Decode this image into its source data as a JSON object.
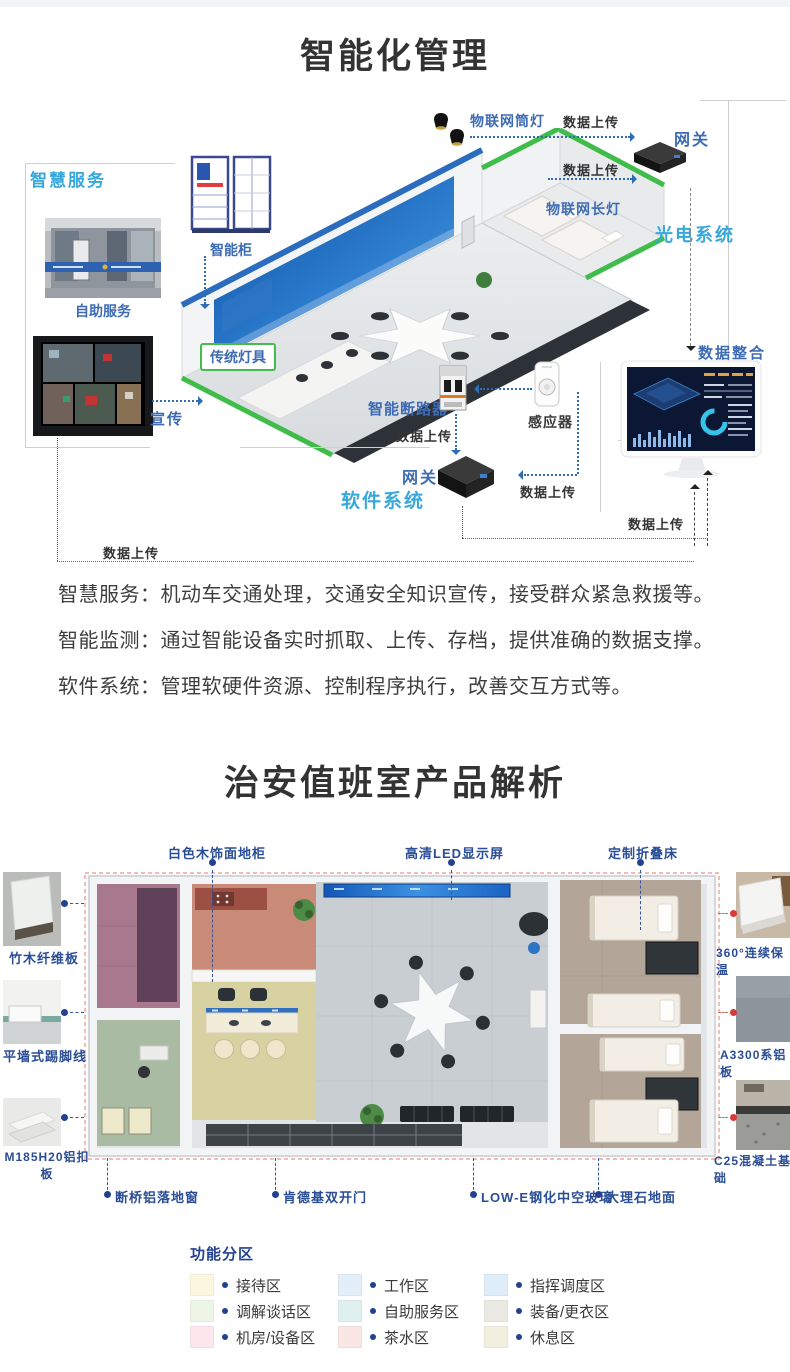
{
  "colors": {
    "label_blue": "#3d6cb4",
    "system_cyan": "#38a8dc",
    "navy": "#23418f",
    "red_dot": "#d93a3a",
    "title": "#333333"
  },
  "s1": {
    "title": "智能化管理",
    "labels": {
      "smart_service": "智慧服务",
      "smart_cabinet": "智能柜",
      "self_service": "自助服务",
      "traditional_light": "传统灯具",
      "publicity": "宣传",
      "iot_downlight": "物联网筒灯",
      "iot_long_light": "物联网长灯",
      "gateway": "网关",
      "optoelectronic_system": "光电系统",
      "smart_breaker": "智能断路器",
      "sensor": "感应器",
      "software_system": "软件系统",
      "data_integration": "数据整合",
      "data_upload": "数据上传"
    },
    "paragraphs": [
      "智慧服务：机动车交通处理，交通安全知识宣传，接受群众紧急救援等。",
      "智能监测：通过智能设备实时抓取、上传、存档，提供准确的数据支撑。",
      "软件系统：管理软硬件资源、控制程序执行，改善交互方式等。"
    ]
  },
  "s2": {
    "title": "治安值班室产品解析",
    "top_labels": [
      "白色木饰面地柜",
      "高清LED显示屏",
      "定制折叠床"
    ],
    "left_labels": [
      "竹木纤维板",
      "平墙式踢脚线",
      "M185H20铝扣板"
    ],
    "right_labels": [
      "360°连续保温",
      "A3300系铝板",
      "C25混凝土基础"
    ],
    "bottom_labels": [
      "断桥铝落地窗",
      "肯德基双开门",
      "LOW-E钢化中空玻璃",
      "大理石地面"
    ],
    "legend": {
      "title": "功能分区",
      "items": [
        {
          "label": "接待区",
          "color": "#faf6e0"
        },
        {
          "label": "工作区",
          "color": "#e3eff8"
        },
        {
          "label": "指挥调度区",
          "color": "#deedf8"
        },
        {
          "label": "调解谈话区",
          "color": "#edf5e7"
        },
        {
          "label": "自助服务区",
          "color": "#e0f0ef"
        },
        {
          "label": "装备/更衣区",
          "color": "#eaeae3"
        },
        {
          "label": "机房/设备区",
          "color": "#fbe7ec"
        },
        {
          "label": "茶水区",
          "color": "#fae6e5"
        },
        {
          "label": "休息区",
          "color": "#f1efde"
        }
      ]
    }
  }
}
